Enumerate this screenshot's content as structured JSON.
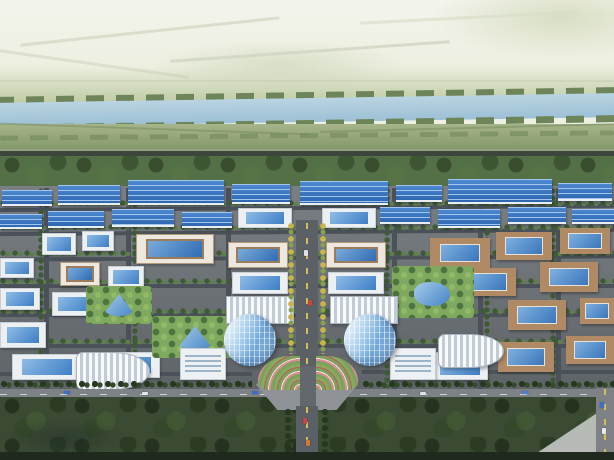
{
  "scene": {
    "kind": "aerial-architectural-rendering",
    "subject": "industrial park master plan, bird's-eye view: river and farmland on the horizon, rows of blue-roofed factories, white office blocks with blue glass roofs, courtyard buildings, a central tree-lined boulevard with twin cylindrical glass towers, a flower plaza, and a dark forest belt in the foreground"
  },
  "palette": {
    "horizon_plain": "#eef0e4",
    "river": "#a9c8da",
    "farmland": "#8ea677",
    "tree_belt": "#547047",
    "park_road": "#4b5158",
    "factory_roof_blue": "#3a78c6",
    "office_white": "#edf0f3",
    "glass_blue": "#3e7ec6",
    "courtyard_tan": "#b08a64",
    "tower_glass": "#9dc3e5",
    "boulevard_dash_yellow": "#d3be52",
    "flower_pink": "#d98c98",
    "flower_red": "#c35560",
    "foreground_forest": "#3b4b33",
    "bottom_edge": "#20291d"
  },
  "name_map": {
    "sky": "distant-plain",
    "patch": "pale-field-patch",
    "faintline": "field-boundary-line",
    "slope": "far-meadow",
    "bank": "riverbank-tree-row",
    "river": "river",
    "fields": "farmland",
    "highway": "highway-road",
    "treeband": "tree-belt",
    "parkbase": "park-ground",
    "road": "street",
    "roadlight": "perimeter-road",
    "blvd": "central-boulevard",
    "hedge": "tree-row",
    "hedgev": "tree-row",
    "ytrees": "golden-tree-median",
    "treesdark": "dense-tree-row",
    "factory": "factory-building",
    "office": "office-building",
    "office2": "office-building",
    "courtyard": "courtyard-building",
    "louver": "louvered-roof-building",
    "wing": "podium-building",
    "tower": "glass-tower",
    "greenpark": "landscaped-park",
    "pond": "pond",
    "plaza": "central-plaza",
    "flowerL": "flower-bed",
    "flowerR": "flower-bed",
    "pale": "paved-clearing",
    "strip": "image-bottom-edge",
    "car": "vehicle",
    "forest": "foreground-forest"
  },
  "layers": [
    {
      "t": "sky",
      "x": 0,
      "y": 0,
      "w": 614,
      "h": 102
    },
    {
      "t": "patch",
      "x": 430,
      "y": -10,
      "w": 220,
      "h": 70,
      "c": "radial-gradient(ellipse at 60% 40%, rgba(205,214,180,0.7), rgba(205,214,180,0) 70%)"
    },
    {
      "t": "patch",
      "x": 150,
      "y": 40,
      "w": 260,
      "h": 50,
      "c": "radial-gradient(ellipse, rgba(198,208,178,0.55), rgba(198,208,178,0) 70%)"
    },
    {
      "t": "faintline",
      "x": 20,
      "y": 30,
      "w": 260,
      "h": 3,
      "r": -6,
      "c": "#d4dac6",
      "o": 0.8
    },
    {
      "t": "faintline",
      "x": 170,
      "y": 50,
      "w": 280,
      "h": 3,
      "r": -4,
      "c": "#cfd6c2",
      "o": 0.8
    },
    {
      "t": "faintline",
      "x": -10,
      "y": 62,
      "w": 200,
      "h": 3,
      "r": 8,
      "c": "#d4dac6",
      "o": 0.7
    },
    {
      "t": "faintline",
      "x": 360,
      "y": 16,
      "w": 220,
      "h": 3,
      "r": -3,
      "c": "#d8dec9",
      "o": 0.7
    },
    {
      "t": "faintline",
      "x": 0,
      "y": 80,
      "w": 614,
      "h": 2,
      "c": "#ccd4bc",
      "o": 0.6
    },
    {
      "t": "slope",
      "x": 0,
      "y": 66,
      "w": 614,
      "h": 40
    },
    {
      "t": "bank",
      "x": -4,
      "y": 92,
      "w": 622,
      "h": 7,
      "r": -0.9
    },
    {
      "t": "river",
      "x": -4,
      "y": 98,
      "w": 622,
      "h": 24,
      "r": -0.9
    },
    {
      "t": "bank",
      "x": -4,
      "y": 120,
      "w": 622,
      "h": 7,
      "r": -0.9
    },
    {
      "t": "fields",
      "x": 0,
      "y": 124,
      "w": 614,
      "h": 30
    },
    {
      "t": "bank",
      "x": 0,
      "y": 133,
      "w": 614,
      "h": 5,
      "o": 0.55,
      "r": -0.5
    },
    {
      "t": "faintline",
      "x": 0,
      "y": 128,
      "w": 310,
      "h": 2,
      "r": 2,
      "c": "#78895f",
      "o": 0.5
    },
    {
      "t": "faintline",
      "x": 320,
      "y": 127,
      "w": 294,
      "h": 2,
      "r": -1.5,
      "c": "#78895f",
      "o": 0.5
    },
    {
      "t": "faintline",
      "x": 0,
      "y": 149,
      "w": 614,
      "h": 2,
      "c": "#9aa188",
      "o": 0.8
    },
    {
      "t": "highway",
      "x": 0,
      "y": 151,
      "w": 614,
      "h": 5
    },
    {
      "t": "treeband",
      "x": 0,
      "y": 156,
      "w": 614,
      "h": 32
    },
    {
      "t": "parkbase",
      "x": 0,
      "y": 186,
      "w": 614,
      "h": 208
    },
    {
      "t": "road",
      "x": 0,
      "y": 206,
      "w": 614,
      "h": 4,
      "r": -0.4
    },
    {
      "t": "road",
      "x": 0,
      "y": 230,
      "w": 614,
      "h": 4,
      "r": -0.4
    },
    {
      "t": "road",
      "x": 0,
      "y": 256,
      "w": 614,
      "h": 4,
      "r": -0.3
    },
    {
      "t": "road",
      "x": 0,
      "y": 284,
      "w": 614,
      "h": 4
    },
    {
      "t": "road",
      "x": 0,
      "y": 313,
      "w": 614,
      "h": 4
    },
    {
      "t": "road",
      "x": 0,
      "y": 344,
      "w": 614,
      "h": 4
    },
    {
      "t": "road",
      "x": 0,
      "y": 372,
      "w": 252,
      "h": 4
    },
    {
      "t": "road",
      "x": 362,
      "y": 370,
      "w": 252,
      "h": 4
    },
    {
      "t": "road",
      "x": 44,
      "y": 188,
      "w": 5,
      "h": 204
    },
    {
      "t": "road",
      "x": 126,
      "y": 188,
      "w": 5,
      "h": 204
    },
    {
      "t": "road",
      "x": 226,
      "y": 188,
      "w": 5,
      "h": 116
    },
    {
      "t": "road",
      "x": 392,
      "y": 188,
      "w": 5,
      "h": 204
    },
    {
      "t": "road",
      "x": 478,
      "y": 188,
      "w": 5,
      "h": 204
    },
    {
      "t": "road",
      "x": 556,
      "y": 188,
      "w": 5,
      "h": 204
    },
    {
      "t": "hedge",
      "x": 0,
      "y": 200,
      "w": 614,
      "h": 7
    },
    {
      "t": "hedge",
      "x": 0,
      "y": 224,
      "w": 614,
      "h": 7
    },
    {
      "t": "hedge",
      "x": 0,
      "y": 250,
      "w": 614,
      "h": 7
    },
    {
      "t": "hedge",
      "x": 0,
      "y": 278,
      "w": 614,
      "h": 7
    },
    {
      "t": "hedge",
      "x": 0,
      "y": 308,
      "w": 614,
      "h": 7
    },
    {
      "t": "hedge",
      "x": 0,
      "y": 338,
      "w": 614,
      "h": 7
    },
    {
      "t": "hedgev",
      "x": 38,
      "y": 188,
      "w": 6,
      "h": 200
    },
    {
      "t": "hedgev",
      "x": 132,
      "y": 188,
      "w": 6,
      "h": 200
    },
    {
      "t": "hedgev",
      "x": 384,
      "y": 188,
      "w": 6,
      "h": 200
    },
    {
      "t": "hedgev",
      "x": 484,
      "y": 188,
      "w": 6,
      "h": 200
    },
    {
      "t": "hedgev",
      "x": 550,
      "y": 188,
      "w": 6,
      "h": 200
    },
    {
      "t": "factory",
      "x": 2,
      "y": 190,
      "w": 50,
      "h": 16
    },
    {
      "t": "factory",
      "x": 58,
      "y": 185,
      "w": 62,
      "h": 20
    },
    {
      "t": "factory",
      "x": 128,
      "y": 180,
      "w": 96,
      "h": 25
    },
    {
      "t": "factory",
      "x": 232,
      "y": 184,
      "w": 58,
      "h": 20
    },
    {
      "t": "factory",
      "x": 300,
      "y": 181,
      "w": 88,
      "h": 24
    },
    {
      "t": "factory",
      "x": 396,
      "y": 185,
      "w": 46,
      "h": 17
    },
    {
      "t": "factory",
      "x": 448,
      "y": 179,
      "w": 104,
      "h": 25
    },
    {
      "t": "factory",
      "x": 558,
      "y": 183,
      "w": 54,
      "h": 18
    },
    {
      "t": "factory",
      "x": 0,
      "y": 214,
      "w": 42,
      "h": 15
    },
    {
      "t": "factory",
      "x": 48,
      "y": 211,
      "w": 56,
      "h": 17
    },
    {
      "t": "factory",
      "x": 112,
      "y": 209,
      "w": 62,
      "h": 18
    },
    {
      "t": "factory",
      "x": 182,
      "y": 212,
      "w": 50,
      "h": 16
    },
    {
      "t": "office",
      "x": 238,
      "y": 208,
      "w": 54,
      "h": 20
    },
    {
      "t": "office",
      "x": 322,
      "y": 208,
      "w": 54,
      "h": 20
    },
    {
      "t": "factory",
      "x": 380,
      "y": 207,
      "w": 50,
      "h": 17
    },
    {
      "t": "factory",
      "x": 438,
      "y": 209,
      "w": 62,
      "h": 19
    },
    {
      "t": "factory",
      "x": 508,
      "y": 207,
      "w": 58,
      "h": 17
    },
    {
      "t": "factory",
      "x": 572,
      "y": 209,
      "w": 42,
      "h": 15
    },
    {
      "t": "office",
      "x": 42,
      "y": 233,
      "w": 34,
      "h": 22
    },
    {
      "t": "office",
      "x": 82,
      "y": 231,
      "w": 32,
      "h": 20
    },
    {
      "t": "office2",
      "x": 136,
      "y": 234,
      "w": 78,
      "h": 30
    },
    {
      "t": "office",
      "x": 0,
      "y": 258,
      "w": 34,
      "h": 20
    },
    {
      "t": "office2",
      "x": 60,
      "y": 262,
      "w": 40,
      "h": 24
    },
    {
      "t": "office",
      "x": 108,
      "y": 266,
      "w": 36,
      "h": 22
    },
    {
      "t": "office",
      "x": 0,
      "y": 288,
      "w": 40,
      "h": 22
    },
    {
      "t": "office",
      "x": 52,
      "y": 292,
      "w": 44,
      "h": 24
    },
    {
      "t": "office",
      "x": 0,
      "y": 322,
      "w": 46,
      "h": 26
    },
    {
      "t": "office",
      "x": 96,
      "y": 352,
      "w": 64,
      "h": 26
    },
    {
      "t": "office",
      "x": 12,
      "y": 354,
      "w": 70,
      "h": 26
    },
    {
      "t": "courtyard",
      "x": 560,
      "y": 228,
      "w": 50,
      "h": 26
    },
    {
      "t": "courtyard",
      "x": 496,
      "y": 232,
      "w": 56,
      "h": 28
    },
    {
      "t": "courtyard",
      "x": 430,
      "y": 238,
      "w": 60,
      "h": 30
    },
    {
      "t": "courtyard",
      "x": 540,
      "y": 262,
      "w": 58,
      "h": 30
    },
    {
      "t": "courtyard",
      "x": 460,
      "y": 268,
      "w": 56,
      "h": 28
    },
    {
      "t": "courtyard",
      "x": 580,
      "y": 298,
      "w": 34,
      "h": 26
    },
    {
      "t": "courtyard",
      "x": 508,
      "y": 300,
      "w": 58,
      "h": 30
    },
    {
      "t": "courtyard",
      "x": 566,
      "y": 336,
      "w": 48,
      "h": 28
    },
    {
      "t": "courtyard",
      "x": 498,
      "y": 342,
      "w": 56,
      "h": 30
    },
    {
      "t": "office",
      "x": 432,
      "y": 352,
      "w": 56,
      "h": 28
    },
    {
      "t": "office2",
      "x": 228,
      "y": 242,
      "w": 60,
      "h": 26
    },
    {
      "t": "office2",
      "x": 326,
      "y": 242,
      "w": 60,
      "h": 26
    },
    {
      "t": "office",
      "x": 232,
      "y": 272,
      "w": 56,
      "h": 22
    },
    {
      "t": "office",
      "x": 328,
      "y": 272,
      "w": 56,
      "h": 22
    },
    {
      "t": "greenpark",
      "x": 86,
      "y": 286,
      "w": 66,
      "h": 38
    },
    {
      "t": "pond",
      "x": 102,
      "y": 294,
      "w": 34,
      "h": 22,
      "clip": "polygon(50% 0,100% 100%,0 100%)"
    },
    {
      "t": "greenpark",
      "x": 152,
      "y": 316,
      "w": 84,
      "h": 42
    },
    {
      "t": "pond",
      "x": 176,
      "y": 326,
      "w": 38,
      "h": 24,
      "clip": "polygon(50% 0,100% 100%,0 100%)"
    },
    {
      "t": "greenpark",
      "x": 392,
      "y": 266,
      "w": 82,
      "h": 52
    },
    {
      "t": "pond",
      "x": 414,
      "y": 282,
      "w": 36,
      "h": 24
    },
    {
      "t": "louver",
      "x": 76,
      "y": 352,
      "w": 74,
      "h": 38,
      "br": "8px 60% 60% 8px"
    },
    {
      "t": "louver",
      "x": 438,
      "y": 334,
      "w": 66,
      "h": 34,
      "br": "8px 60% 60% 8px"
    },
    {
      "t": "louver",
      "x": 226,
      "y": 296,
      "w": 68,
      "h": 28
    },
    {
      "t": "louver",
      "x": 330,
      "y": 296,
      "w": 68,
      "h": 28
    },
    {
      "t": "wing",
      "x": 180,
      "y": 348,
      "w": 46,
      "h": 32
    },
    {
      "t": "wing",
      "x": 390,
      "y": 348,
      "w": 46,
      "h": 32
    },
    {
      "t": "blvd",
      "x": 296,
      "y": 220,
      "w": 22,
      "h": 150
    },
    {
      "t": "ytrees",
      "x": 287,
      "y": 222,
      "w": 9,
      "h": 132
    },
    {
      "t": "ytrees",
      "x": 319,
      "y": 222,
      "w": 9,
      "h": 132
    },
    {
      "t": "car",
      "x": 304,
      "y": 250,
      "w": 4,
      "h": 6,
      "c": "#dfe3e6"
    },
    {
      "t": "car",
      "x": 308,
      "y": 300,
      "w": 4,
      "h": 6,
      "c": "#c4483e"
    },
    {
      "t": "tower",
      "x": 224,
      "y": 314,
      "w": 52,
      "h": 52
    },
    {
      "t": "tower",
      "x": 344,
      "y": 314,
      "w": 52,
      "h": 52
    },
    {
      "t": "treesdark",
      "x": 0,
      "y": 380,
      "w": 252,
      "h": 9
    },
    {
      "t": "treesdark",
      "x": 362,
      "y": 380,
      "w": 252,
      "h": 9
    },
    {
      "t": "roadlight",
      "x": 0,
      "y": 389,
      "w": 614,
      "h": 9
    },
    {
      "t": "forest",
      "x": 0,
      "y": 397,
      "w": 614,
      "h": 58
    },
    {
      "t": "patch",
      "x": 0,
      "y": 418,
      "w": 130,
      "h": 42,
      "c": "radial-gradient(ellipse, rgba(30,44,38,0.45), rgba(30,44,38,0) 70%)"
    },
    {
      "t": "pale",
      "x": 468,
      "y": 398,
      "w": 146,
      "h": 62,
      "clip": "polygon(100% 6%, 100% 100%, 40% 100%)"
    },
    {
      "t": "plaza",
      "x": 256,
      "y": 366,
      "w": 102,
      "h": 44
    },
    {
      "t": "flowerL",
      "x": 258,
      "y": 356,
      "w": 42,
      "h": 34
    },
    {
      "t": "flowerR",
      "x": 316,
      "y": 356,
      "w": 42,
      "h": 34
    },
    {
      "t": "road",
      "x": 300,
      "y": 366,
      "w": 16,
      "h": 44,
      "c": "#63686d"
    },
    {
      "t": "blvd",
      "x": 296,
      "y": 406,
      "w": 22,
      "h": 54
    },
    {
      "t": "treesdark",
      "x": 284,
      "y": 408,
      "w": 9,
      "h": 52
    },
    {
      "t": "treesdark",
      "x": 321,
      "y": 408,
      "w": 9,
      "h": 52
    },
    {
      "t": "blvd",
      "x": 596,
      "y": 388,
      "w": 18,
      "h": 72,
      "c": "#7e8286"
    },
    {
      "t": "car",
      "x": 64,
      "y": 391,
      "w": 6,
      "h": 3,
      "c": "#3a6fd0"
    },
    {
      "t": "car",
      "x": 142,
      "y": 392,
      "w": 6,
      "h": 3,
      "c": "#e8ebee"
    },
    {
      "t": "car",
      "x": 252,
      "y": 391,
      "w": 6,
      "h": 3,
      "c": "#3a6fd0"
    },
    {
      "t": "car",
      "x": 420,
      "y": 392,
      "w": 6,
      "h": 3,
      "c": "#dde2e6"
    },
    {
      "t": "car",
      "x": 522,
      "y": 391,
      "w": 6,
      "h": 3,
      "c": "#4a80d8"
    },
    {
      "t": "car",
      "x": 303,
      "y": 418,
      "w": 4,
      "h": 6,
      "c": "#c4483e"
    },
    {
      "t": "car",
      "x": 306,
      "y": 440,
      "w": 4,
      "h": 6,
      "c": "#d07a35"
    },
    {
      "t": "car",
      "x": 600,
      "y": 402,
      "w": 4,
      "h": 6,
      "c": "#3a6fd0"
    },
    {
      "t": "car",
      "x": 602,
      "y": 428,
      "w": 4,
      "h": 6,
      "c": "#e8ebee"
    },
    {
      "t": "strip",
      "x": 0,
      "y": 452,
      "w": 614,
      "h": 8
    }
  ]
}
